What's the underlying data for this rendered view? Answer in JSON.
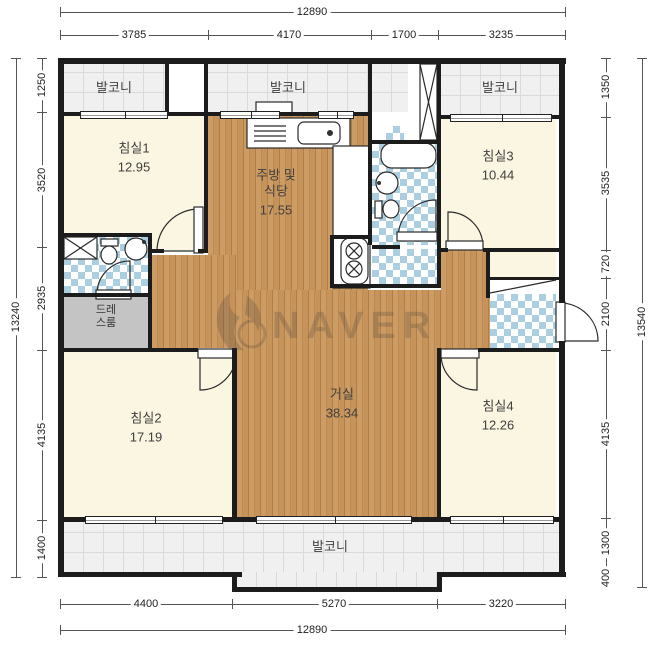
{
  "watermark": {
    "text": "NAVER"
  },
  "plan": {
    "regions": [
      {
        "name": "balcony-top-left-floor",
        "x": 64,
        "y": 64,
        "w": 101,
        "h": 48,
        "fill": "tile"
      },
      {
        "name": "balcony-top-center-floor",
        "x": 208,
        "y": 64,
        "w": 160,
        "h": 48,
        "fill": "tile"
      },
      {
        "name": "shaft-floor",
        "x": 372,
        "y": 64,
        "w": 36,
        "h": 48,
        "fill": "tile"
      },
      {
        "name": "balcony-top-right-floor",
        "x": 441,
        "y": 64,
        "w": 119,
        "h": 51,
        "fill": "tile"
      },
      {
        "name": "bedroom1-floor",
        "x": 64,
        "y": 116,
        "w": 140,
        "h": 135,
        "fill": "cream"
      },
      {
        "name": "kitchen-floor",
        "x": 208,
        "y": 116,
        "w": 160,
        "h": 174,
        "fill": "wood"
      },
      {
        "name": "common-bath-floor",
        "x": 372,
        "y": 144,
        "w": 65,
        "h": 101,
        "fill": "checker"
      },
      {
        "name": "bath-patch-floor",
        "x": 386,
        "y": 126,
        "w": 18,
        "h": 16,
        "fill": "checker"
      },
      {
        "name": "utility-floor",
        "x": 372,
        "y": 249,
        "w": 65,
        "h": 35,
        "fill": "checker"
      },
      {
        "name": "bedroom3-floor",
        "x": 441,
        "y": 119,
        "w": 115,
        "h": 129,
        "fill": "cream"
      },
      {
        "name": "hall-left-floor",
        "x": 152,
        "y": 255,
        "w": 85,
        "h": 93,
        "fill": "wood"
      },
      {
        "name": "left-bath-floor",
        "x": 64,
        "y": 237,
        "w": 88,
        "h": 56,
        "fill": "checker"
      },
      {
        "name": "dressroom-floor",
        "x": 64,
        "y": 297,
        "w": 88,
        "h": 51,
        "fill": "gray"
      },
      {
        "name": "bedroom2-floor",
        "x": 64,
        "y": 352,
        "w": 168,
        "h": 165,
        "fill": "cream"
      },
      {
        "name": "living-floor",
        "x": 237,
        "y": 290,
        "w": 204,
        "h": 227,
        "fill": "wood"
      },
      {
        "name": "hall-right-floor",
        "x": 441,
        "y": 250,
        "w": 49,
        "h": 102,
        "fill": "wood"
      },
      {
        "name": "closet-floor",
        "x": 490,
        "y": 250,
        "w": 66,
        "h": 27,
        "fill": "cream"
      },
      {
        "name": "entry-floor",
        "x": 490,
        "y": 294,
        "w": 66,
        "h": 54,
        "fill": "checker"
      },
      {
        "name": "bedroom4-floor",
        "x": 441,
        "y": 352,
        "w": 115,
        "h": 165,
        "fill": "cream"
      },
      {
        "name": "balcony-bottom-floor",
        "x": 64,
        "y": 522,
        "w": 496,
        "h": 50,
        "fill": "tile"
      },
      {
        "name": "balcony-bottom-ext-floor",
        "x": 237,
        "y": 572,
        "w": 200,
        "h": 16,
        "fill": "tile"
      }
    ],
    "walls": [
      {
        "x": 58,
        "y": 58,
        "w": 508,
        "h": 6
      },
      {
        "x": 58,
        "y": 58,
        "w": 6,
        "h": 519
      },
      {
        "x": 559,
        "y": 58,
        "w": 6,
        "h": 245
      },
      {
        "x": 559,
        "y": 341,
        "w": 6,
        "h": 236
      },
      {
        "x": 58,
        "y": 572,
        "w": 184,
        "h": 5
      },
      {
        "x": 437,
        "y": 572,
        "w": 129,
        "h": 5
      },
      {
        "x": 232,
        "y": 587,
        "w": 210,
        "h": 5
      },
      {
        "x": 232,
        "y": 572,
        "w": 5,
        "h": 20
      },
      {
        "x": 437,
        "y": 572,
        "w": 5,
        "h": 20
      },
      {
        "x": 64,
        "y": 112,
        "w": 144,
        "h": 4
      },
      {
        "x": 208,
        "y": 112,
        "w": 164,
        "h": 4
      },
      {
        "x": 441,
        "y": 115,
        "w": 119,
        "h": 4
      },
      {
        "x": 58,
        "y": 233,
        "w": 94,
        "h": 4
      },
      {
        "x": 152,
        "y": 249,
        "w": 12,
        "h": 4
      },
      {
        "x": 198,
        "y": 249,
        "w": 10,
        "h": 4
      },
      {
        "x": 58,
        "y": 293,
        "w": 94,
        "h": 4
      },
      {
        "x": 58,
        "y": 348,
        "w": 140,
        "h": 4
      },
      {
        "x": 330,
        "y": 235,
        "w": 42,
        "h": 4
      },
      {
        "x": 330,
        "y": 284,
        "w": 111,
        "h": 4
      },
      {
        "x": 372,
        "y": 140,
        "w": 65,
        "h": 4
      },
      {
        "x": 372,
        "y": 245,
        "w": 28,
        "h": 4
      },
      {
        "x": 437,
        "y": 248,
        "w": 11,
        "h": 4
      },
      {
        "x": 483,
        "y": 248,
        "w": 77,
        "h": 4
      },
      {
        "x": 478,
        "y": 348,
        "w": 82,
        "h": 4
      },
      {
        "x": 486,
        "y": 277,
        "w": 74,
        "h": 3
      },
      {
        "x": 64,
        "y": 517,
        "w": 496,
        "h": 5
      },
      {
        "x": 165,
        "y": 58,
        "w": 4,
        "h": 58
      },
      {
        "x": 204,
        "y": 58,
        "w": 4,
        "h": 195
      },
      {
        "x": 368,
        "y": 58,
        "w": 4,
        "h": 58
      },
      {
        "x": 368,
        "y": 116,
        "w": 4,
        "h": 129
      },
      {
        "x": 437,
        "y": 58,
        "w": 4,
        "h": 230
      },
      {
        "x": 330,
        "y": 239,
        "w": 4,
        "h": 49
      },
      {
        "x": 148,
        "y": 233,
        "w": 4,
        "h": 119
      },
      {
        "x": 232,
        "y": 348,
        "w": 5,
        "h": 174
      },
      {
        "x": 437,
        "y": 348,
        "w": 4,
        "h": 174
      },
      {
        "x": 486,
        "y": 248,
        "w": 4,
        "h": 50
      }
    ],
    "windows": [
      {
        "x": 80,
        "y": 111,
        "w": 88,
        "h": 8
      },
      {
        "x": 220,
        "y": 111,
        "w": 60,
        "h": 8
      },
      {
        "x": 318,
        "y": 111,
        "w": 36,
        "h": 8
      },
      {
        "x": 450,
        "y": 114,
        "w": 102,
        "h": 8
      },
      {
        "x": 85,
        "y": 516,
        "w": 138,
        "h": 8
      },
      {
        "x": 256,
        "y": 516,
        "w": 156,
        "h": 8
      },
      {
        "x": 450,
        "y": 516,
        "w": 104,
        "h": 8
      }
    ],
    "shapes": [
      {
        "t": "pie",
        "cx": 199,
        "cy": 251,
        "r": 42,
        "x1": 157,
        "y1": 251,
        "x2": 199,
        "y2": 209,
        "sw": 1
      },
      {
        "t": "rect",
        "x": 194,
        "y": 207,
        "w": 9,
        "h": 46,
        "f": "#fff"
      },
      {
        "t": "pie",
        "cx": 200,
        "cy": 354,
        "r": 36,
        "x1": 236,
        "y1": 354,
        "x2": 200,
        "y2": 390,
        "sw": 1
      },
      {
        "t": "rect",
        "x": 198,
        "y": 349,
        "w": 38,
        "h": 9,
        "f": "#fff"
      },
      {
        "t": "pie",
        "cx": 477,
        "cy": 354,
        "r": 36,
        "x1": 441,
        "y1": 354,
        "x2": 477,
        "y2": 390,
        "sw": 0
      },
      {
        "t": "rect",
        "x": 441,
        "y": 349,
        "w": 38,
        "h": 9,
        "f": "#fff"
      },
      {
        "t": "pie",
        "cx": 448,
        "cy": 247,
        "r": 35,
        "x1": 483,
        "y1": 247,
        "x2": 448,
        "y2": 212,
        "sw": 0
      },
      {
        "t": "rect",
        "x": 446,
        "y": 241,
        "w": 37,
        "h": 9,
        "f": "#fff"
      },
      {
        "t": "pie",
        "cx": 436,
        "cy": 238,
        "r": 38,
        "x1": 398,
        "y1": 238,
        "x2": 436,
        "y2": 200,
        "sw": 1
      },
      {
        "t": "rect",
        "x": 397,
        "y": 232,
        "w": 40,
        "h": 9,
        "f": "#fff"
      },
      {
        "t": "pie",
        "cx": 130,
        "cy": 294,
        "r": 33,
        "x1": 97,
        "y1": 294,
        "x2": 130,
        "y2": 261,
        "sw": 1
      },
      {
        "t": "rect",
        "x": 96,
        "y": 290,
        "w": 35,
        "h": 9,
        "f": "#fff"
      },
      {
        "t": "pie",
        "cx": 560,
        "cy": 341,
        "r": 38,
        "x1": 560,
        "y1": 303,
        "x2": 598,
        "y2": 341,
        "sw": 1
      },
      {
        "t": "rect",
        "x": 556,
        "y": 302,
        "w": 9,
        "h": 40,
        "f": "#fff"
      },
      {
        "t": "rect",
        "x": 247,
        "y": 118,
        "w": 103,
        "h": 30,
        "f": "#fff"
      },
      {
        "t": "rect",
        "x": 333,
        "y": 146,
        "w": 37,
        "h": 142,
        "f": "#fff"
      },
      {
        "t": "rect",
        "x": 298,
        "y": 122,
        "w": 42,
        "h": 22,
        "rx": 6,
        "f": "#fff"
      },
      {
        "t": "circle",
        "cx": 330,
        "cy": 133,
        "r": 3,
        "f": "#333"
      },
      {
        "t": "line",
        "x1": 254,
        "y1": 126,
        "x2": 286,
        "y2": 126
      },
      {
        "t": "line",
        "x1": 254,
        "y1": 131,
        "x2": 286,
        "y2": 131
      },
      {
        "t": "line",
        "x1": 254,
        "y1": 136,
        "x2": 286,
        "y2": 136
      },
      {
        "t": "line",
        "x1": 254,
        "y1": 141,
        "x2": 286,
        "y2": 141
      },
      {
        "t": "rect",
        "x": 341,
        "y": 238,
        "w": 27,
        "h": 46,
        "rx": 9,
        "f": "#fff"
      },
      {
        "t": "circle",
        "cx": 354,
        "cy": 251,
        "r": 8,
        "f": "#fff"
      },
      {
        "t": "xcircle",
        "cx": 354,
        "cy": 251,
        "r": 8
      },
      {
        "t": "circle",
        "cx": 354,
        "cy": 269,
        "r": 8,
        "f": "#fff"
      },
      {
        "t": "xcircle",
        "cx": 354,
        "cy": 269,
        "r": 8
      },
      {
        "t": "rect",
        "x": 381,
        "y": 143,
        "w": 55,
        "h": 25,
        "rx": 11,
        "f": "#fff"
      },
      {
        "t": "circle",
        "cx": 387,
        "cy": 183,
        "r": 11,
        "f": "#fff"
      },
      {
        "t": "circle",
        "cx": 379,
        "cy": 183,
        "r": 2,
        "f": "#333"
      },
      {
        "t": "rect",
        "x": 375,
        "y": 201,
        "w": 7,
        "h": 17,
        "f": "#fff"
      },
      {
        "t": "ellipse",
        "cx": 391,
        "cy": 209,
        "rx": 8,
        "ry": 9,
        "f": "#fff"
      },
      {
        "t": "rect",
        "x": 64,
        "y": 237,
        "w": 33,
        "h": 22,
        "f": "#fff"
      },
      {
        "t": "line",
        "x1": 64,
        "y1": 237,
        "x2": 97,
        "y2": 259
      },
      {
        "t": "line",
        "x1": 97,
        "y1": 237,
        "x2": 64,
        "y2": 259
      },
      {
        "t": "rect",
        "x": 101,
        "y": 239,
        "w": 17,
        "h": 7,
        "f": "#fff"
      },
      {
        "t": "ellipse",
        "cx": 109,
        "cy": 255,
        "rx": 8,
        "ry": 9,
        "f": "#fff"
      },
      {
        "t": "circle",
        "cx": 136,
        "cy": 249,
        "r": 11,
        "f": "#fff"
      },
      {
        "t": "circle",
        "cx": 144,
        "cy": 242,
        "r": 2,
        "f": "#333"
      },
      {
        "t": "rect",
        "x": 420,
        "y": 64,
        "w": 17,
        "h": 76,
        "f": "#fff"
      },
      {
        "t": "line",
        "x1": 420,
        "y1": 64,
        "x2": 437,
        "y2": 140
      },
      {
        "t": "line",
        "x1": 437,
        "y1": 64,
        "x2": 420,
        "y2": 140
      },
      {
        "t": "line",
        "x1": 490,
        "y1": 293,
        "x2": 556,
        "y2": 280
      },
      {
        "t": "rect",
        "x": 256,
        "y": 102,
        "w": 36,
        "h": 12,
        "f": "#fff"
      }
    ],
    "room_labels": [
      {
        "name": "balcony-top-left",
        "lines": [
          "발코니"
        ],
        "cx": 114,
        "cy": 88
      },
      {
        "name": "balcony-top-center",
        "lines": [
          "발코니"
        ],
        "cx": 288,
        "cy": 88
      },
      {
        "name": "balcony-top-right",
        "lines": [
          "발코니"
        ],
        "cx": 500,
        "cy": 88
      },
      {
        "name": "bedroom1",
        "lines": [
          "침실1"
        ],
        "area": "12.95",
        "cx": 134,
        "cy": 158
      },
      {
        "name": "kitchen-dining",
        "lines": [
          "주방 및",
          "식당"
        ],
        "area": "17.55",
        "cx": 276,
        "cy": 193
      },
      {
        "name": "bedroom3",
        "lines": [
          "침실3"
        ],
        "area": "10.44",
        "cx": 498,
        "cy": 166
      },
      {
        "name": "dressroom",
        "lines": [
          "드레",
          "스룸"
        ],
        "cx": 106,
        "cy": 317,
        "small": true
      },
      {
        "name": "living",
        "lines": [
          "거실"
        ],
        "area": "38.34",
        "cx": 342,
        "cy": 404
      },
      {
        "name": "bedroom2",
        "lines": [
          "침실2"
        ],
        "area": "17.19",
        "cx": 146,
        "cy": 428
      },
      {
        "name": "bedroom4",
        "lines": [
          "침실4"
        ],
        "area": "12.26",
        "cx": 498,
        "cy": 416
      },
      {
        "name": "balcony-bottom",
        "lines": [
          "발코니"
        ],
        "cx": 330,
        "cy": 547
      }
    ],
    "dimensions": {
      "horizontal": [
        {
          "y": 12,
          "x1": 60,
          "x2": 565,
          "ticks": [
            60,
            565
          ],
          "labels": [
            {
              "text": "12890",
              "at": 312
            }
          ]
        },
        {
          "y": 35,
          "x1": 60,
          "x2": 565,
          "ticks": [
            60,
            208,
            371,
            438,
            565
          ],
          "labels": [
            {
              "text": "3785",
              "at": 134
            },
            {
              "text": "4170",
              "at": 289
            },
            {
              "text": "1700",
              "at": 404
            },
            {
              "text": "3235",
              "at": 501
            }
          ]
        },
        {
          "y": 604,
          "x1": 60,
          "x2": 565,
          "ticks": [
            60,
            232,
            437,
            565
          ],
          "labels": [
            {
              "text": "4400",
              "at": 146
            },
            {
              "text": "5270",
              "at": 334
            },
            {
              "text": "3220",
              "at": 501
            }
          ]
        },
        {
          "y": 630,
          "x1": 60,
          "x2": 565,
          "ticks": [
            60,
            565
          ],
          "labels": [
            {
              "text": "12890",
              "at": 312
            }
          ]
        }
      ],
      "vertical": [
        {
          "x": 16,
          "y1": 58,
          "y2": 577,
          "ticks": [
            58,
            577
          ],
          "labels": [
            {
              "text": "13240",
              "at": 317
            }
          ]
        },
        {
          "x": 42,
          "y1": 58,
          "y2": 577,
          "ticks": [
            58,
            112,
            247,
            350,
            520,
            577
          ],
          "labels": [
            {
              "text": "1250",
              "at": 85
            },
            {
              "text": "3520",
              "at": 180
            },
            {
              "text": "2935",
              "at": 298
            },
            {
              "text": "4135",
              "at": 435
            },
            {
              "text": "1400",
              "at": 548
            }
          ]
        },
        {
          "x": 606,
          "y1": 58,
          "y2": 587,
          "ticks": [
            58,
            117,
            250,
            278,
            350,
            518,
            569,
            587
          ],
          "labels": [
            {
              "text": "1350",
              "at": 87
            },
            {
              "text": "3535",
              "at": 183
            },
            {
              "text": "720",
              "at": 264
            },
            {
              "text": "2100",
              "at": 314
            },
            {
              "text": "4135",
              "at": 434
            },
            {
              "text": "1300",
              "at": 543
            },
            {
              "text": "400",
              "at": 578
            }
          ]
        },
        {
          "x": 642,
          "y1": 58,
          "y2": 587,
          "ticks": [
            58,
            587
          ],
          "labels": [
            {
              "text": "13540",
              "at": 322
            }
          ]
        }
      ]
    }
  }
}
